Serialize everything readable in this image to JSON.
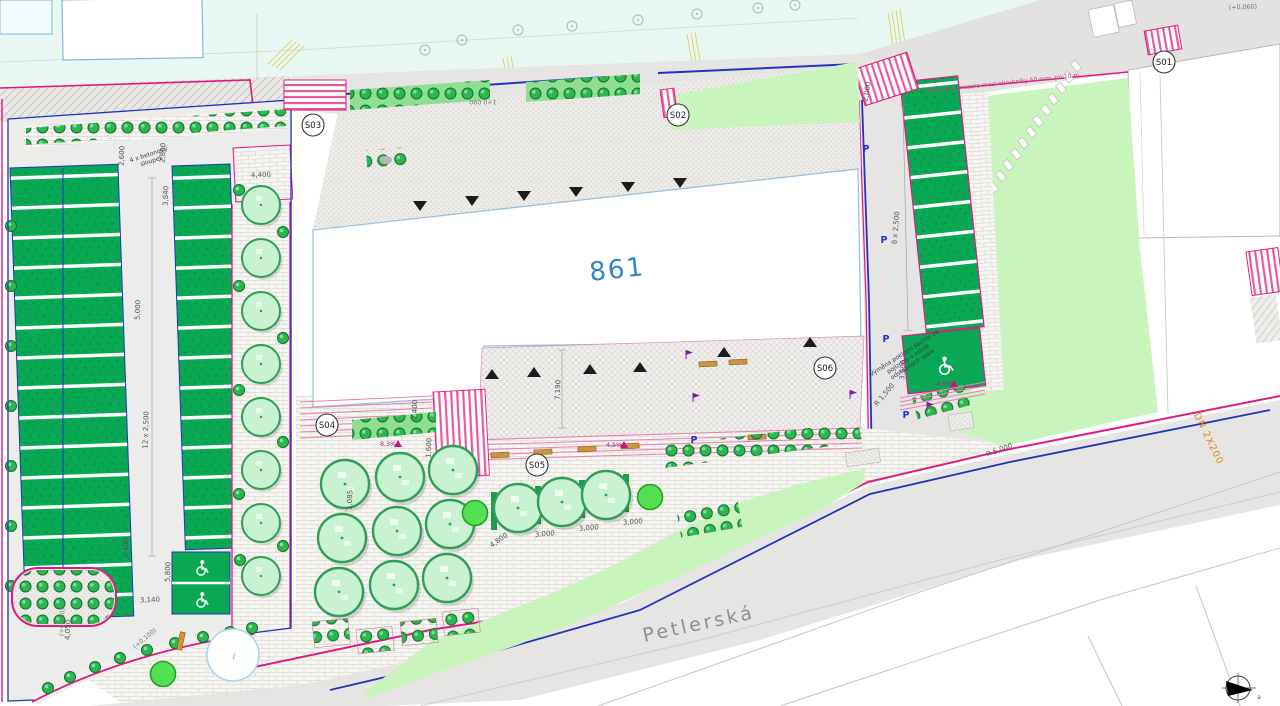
{
  "plan": {
    "parcel_label": "861",
    "street_label": "Petlerská",
    "utility_label": "DN 2X200",
    "markers": [
      {
        "id": "S01"
      },
      {
        "id": "S02"
      },
      {
        "id": "S03"
      },
      {
        "id": "S04"
      },
      {
        "id": "S05"
      },
      {
        "id": "S06"
      }
    ],
    "levels": {
      "rel_100": "(+0,100)",
      "rel_60": "(+0,060)",
      "chainage": "1+0 090"
    },
    "dims": {
      "w_2600": "2,600",
      "w_2800": "2,800",
      "w_3840": "3,840",
      "stalls_left": "12 x 2,500",
      "aisle_5000": "5,000",
      "w_2400": "2,400",
      "w_5800": "5,800",
      "w_3140": "3,140",
      "w_4050": "4,050",
      "w_4400": "4,400",
      "plaza_7190": "7,190",
      "w_1600": "1,600",
      "w_1085": "1,085",
      "w_3000": "3,000",
      "w_4800": "4,800",
      "stalls_right": "8 x 2,500",
      "w_3500": "3,500",
      "r_1500": "R 1,500",
      "r_5000": "R 5,000",
      "w_2000": "2,000"
    },
    "slopes": {
      "s_83": "8,3%",
      "s_45": "4,5%"
    },
    "notes": {
      "bollards_line1": "4 x betonový",
      "bollards_line2": "sloupek",
      "manhole_line1": "Výměna poklopu šachty za",
      "manhole_line2": "pojízdný v místě",
      "manhole_line3": "odstavných stání",
      "curb_note": "(Okrajová) mezera mezi obrubníky 50 mm, po 10 m",
      "parking_letter": "P",
      "pond_mark": "i",
      "north_mark": "a"
    },
    "icons": {
      "north_arrow": "compass-north-arrow",
      "wheelchair": "accessible-parking-symbol",
      "entrance_triangle": "entrance-marker",
      "lamp_flag": "light-pole-flag"
    },
    "colors": {
      "boundary_magenta": "#e11a81",
      "line_blue": "#2433bb",
      "stall_green": "#09a855",
      "lawn_green": "#c9f5bd",
      "tree_fill": "#c9f2d3",
      "tree_rim": "#2f9e57",
      "bench_orange": "#cf9440",
      "parcel_text_blue": "#2e86c8",
      "utility_orange": "#e08a00",
      "background_mint": "#e8f7f1"
    }
  }
}
